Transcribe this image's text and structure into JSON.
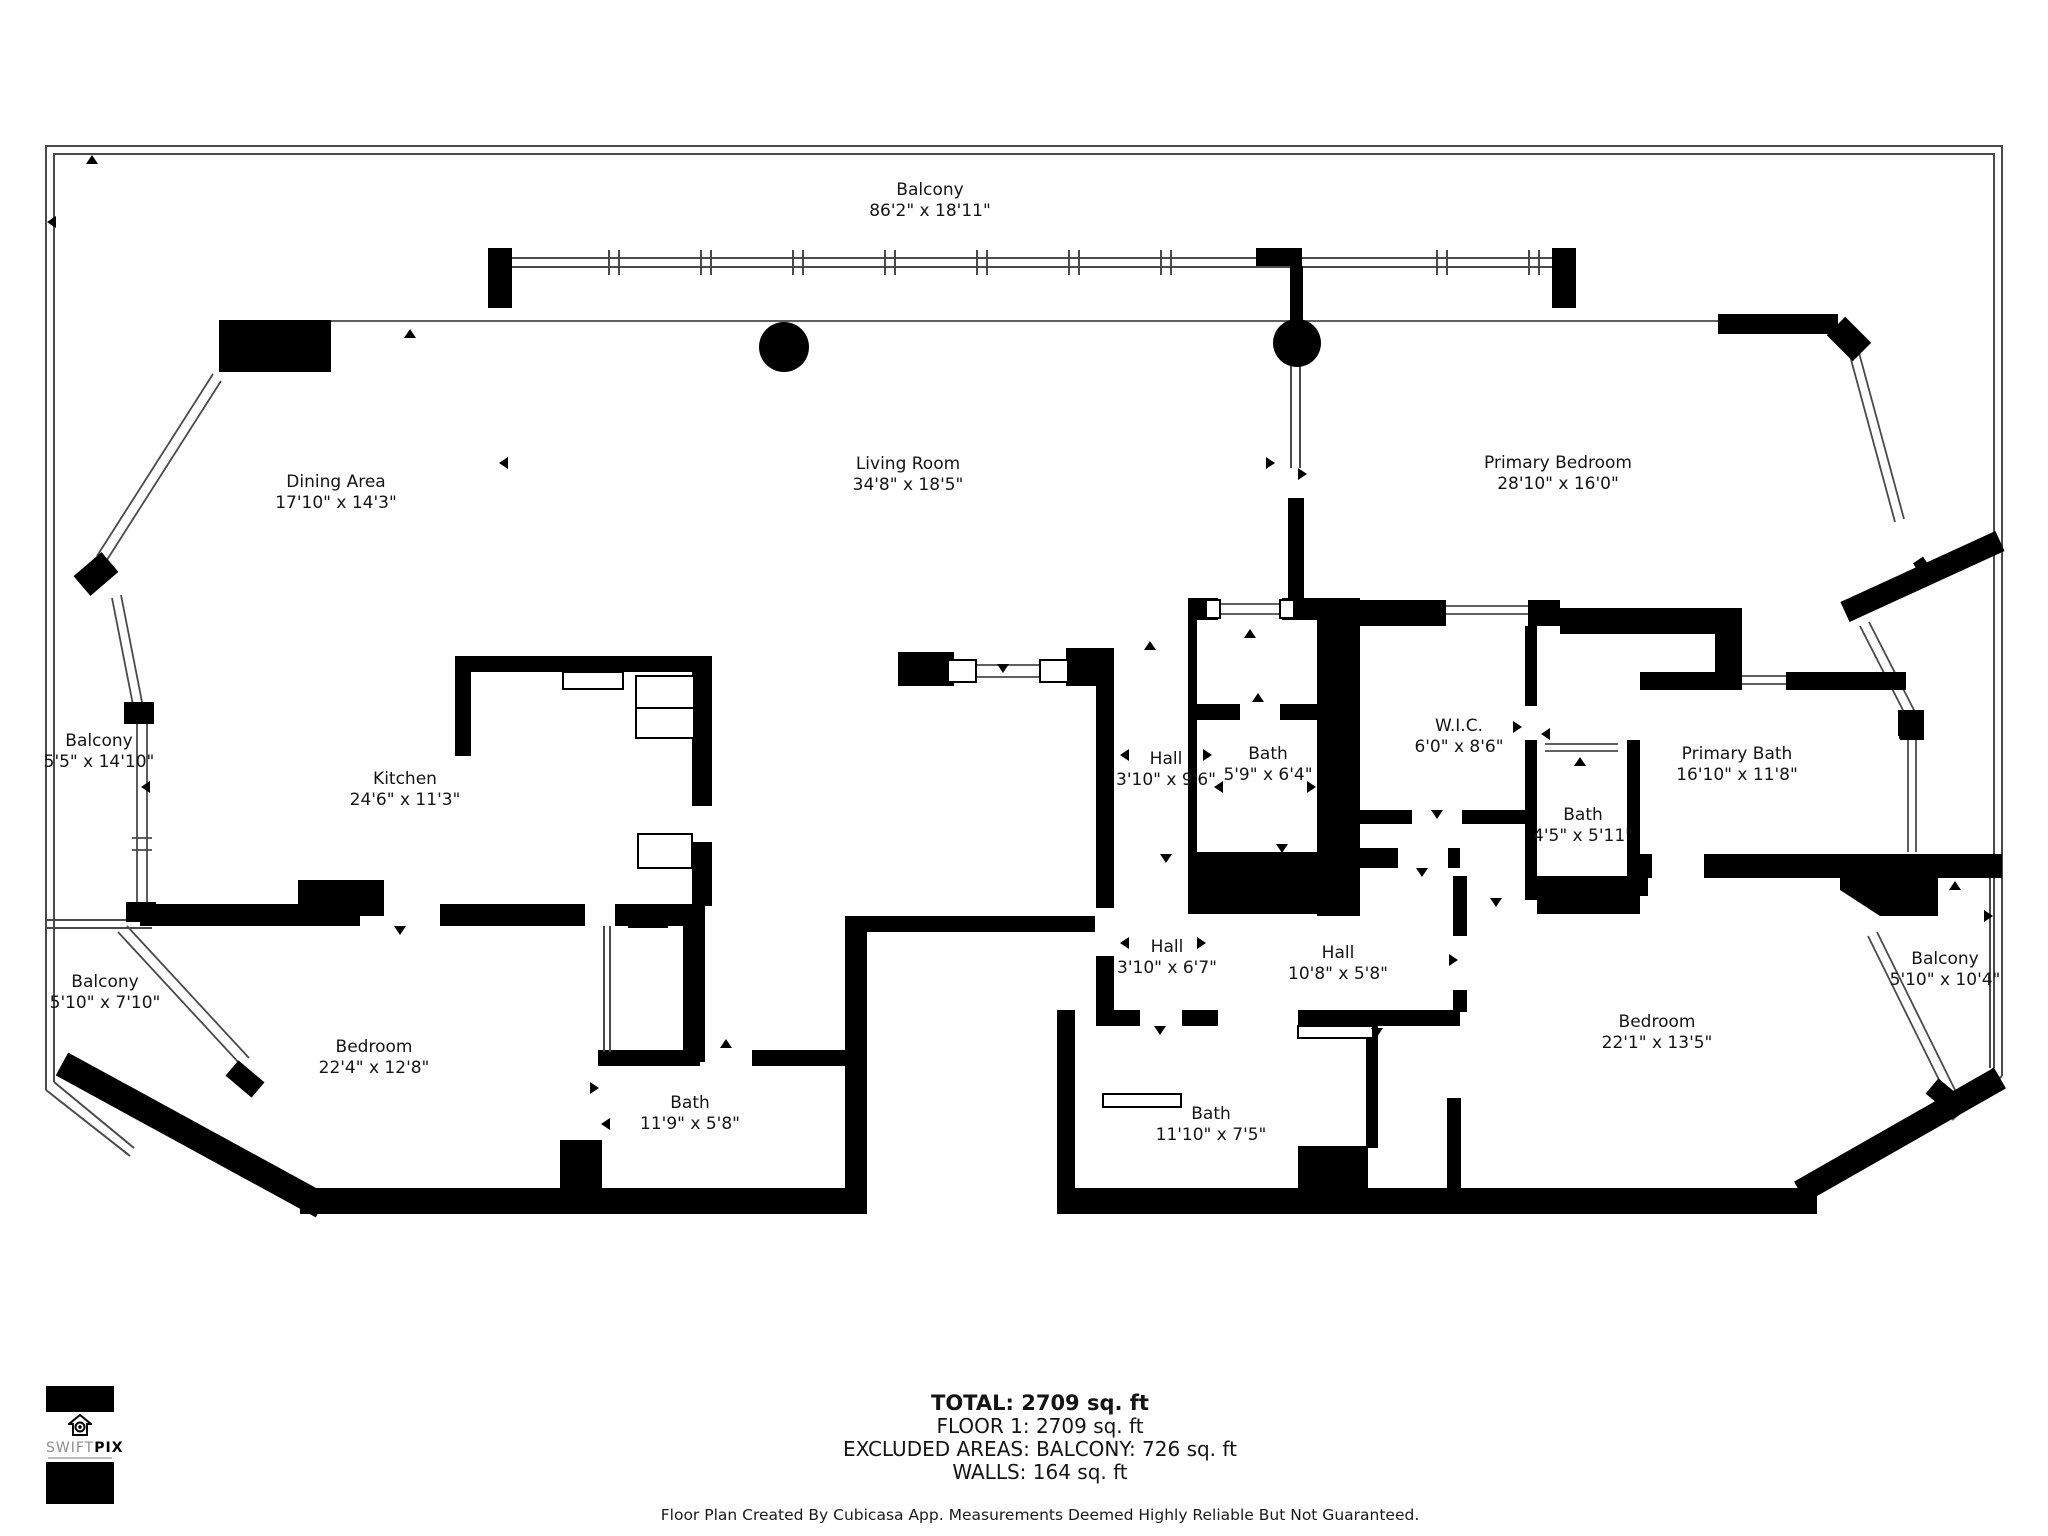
{
  "rooms": [
    {
      "name": "Balcony",
      "dims": "86'2\" x 18'11\""
    },
    {
      "name": "Dining Area",
      "dims": "17'10\" x 14'3\""
    },
    {
      "name": "Living Room",
      "dims": "34'8\" x 18'5\""
    },
    {
      "name": "Primary Bedroom",
      "dims": "28'10\" x 16'0\""
    },
    {
      "name": "Balcony",
      "dims": "5'5\" x 14'10\""
    },
    {
      "name": "Kitchen",
      "dims": "24'6\" x 11'3\""
    },
    {
      "name": "Hall",
      "dims": "3'10\" x 9'6\""
    },
    {
      "name": "Bath",
      "dims": "5'9\" x 6'4\""
    },
    {
      "name": "W.I.C.",
      "dims": "6'0\" x 8'6\""
    },
    {
      "name": "Primary Bath",
      "dims": "16'10\" x 11'8\""
    },
    {
      "name": "Bath",
      "dims": "4'5\" x 5'11\""
    },
    {
      "name": "Balcony",
      "dims": "5'10\" x 7'10\""
    },
    {
      "name": "Bedroom",
      "dims": "22'4\" x 12'8\""
    },
    {
      "name": "Bath",
      "dims": "11'9\" x 5'8\""
    },
    {
      "name": "Hall",
      "dims": "3'10\" x 6'7\""
    },
    {
      "name": "Hall",
      "dims": "10'8\" x 5'8\""
    },
    {
      "name": "Bath",
      "dims": "11'10\" x 7'5\""
    },
    {
      "name": "Bedroom",
      "dims": "22'1\" x 13'5\""
    },
    {
      "name": "Balcony",
      "dims": "5'10\" x 10'4\""
    }
  ],
  "summary": {
    "total": "TOTAL: 2709 sq. ft",
    "floor": "FLOOR 1: 2709 sq. ft",
    "excluded": "EXCLUDED AREAS: BALCONY: 726 sq. ft",
    "walls": "WALLS: 164 sq. ft"
  },
  "footer": "Floor Plan Created By Cubicasa App. Measurements Deemed Highly Reliable But Not Guaranteed.",
  "logo": {
    "brand_light": "SWIFT",
    "brand_bold": "PIX"
  },
  "colors": {
    "wall": "#000000",
    "thin_line": "#4a4a4a",
    "background": "#ffffff"
  }
}
